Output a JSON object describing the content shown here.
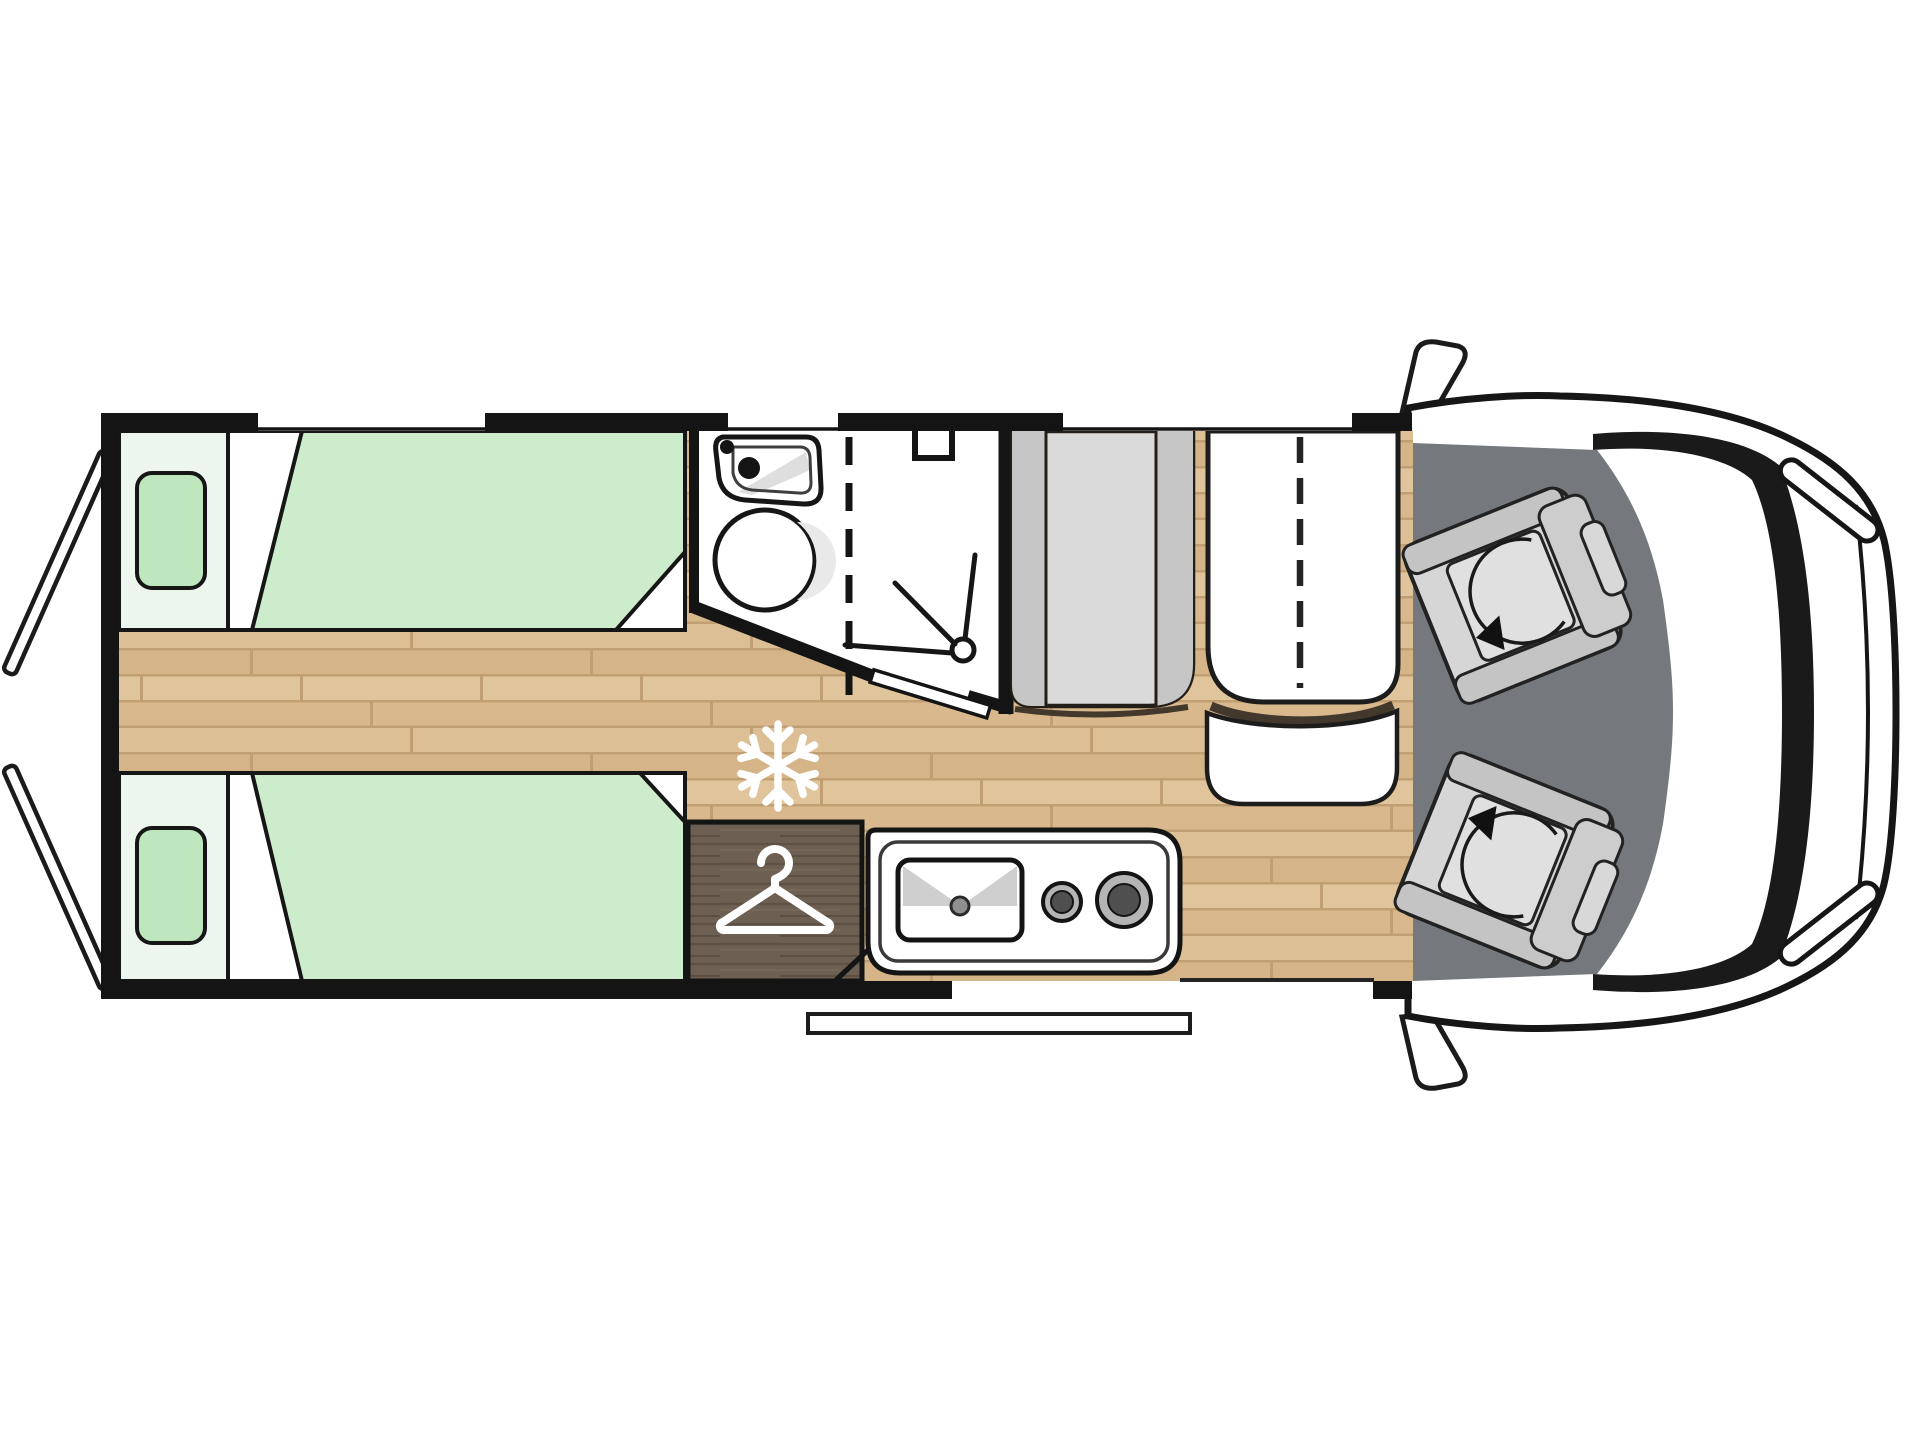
{
  "meta": {
    "title": "Campervan floor plan, top view",
    "description": "Schematic top-view floor plan: rear twin single beds, central washroom with shower, wardrobe, kitchen block with sink and two burners, dinette with folding table, driver cab with two swivel seats, open rear doors and side entry step."
  },
  "colors": {
    "background": "#ffffff",
    "wall": "#141414",
    "outline": "#1b1b1b",
    "wood_base": "#d9ba8e",
    "wood_row1": "#ddbf95",
    "wood_row2": "#d5b487",
    "wood_row3": "#e0c49b",
    "wood_row4": "#d8b88c",
    "wood_seam": "#c29f73",
    "mattress_green": "#cdeccb",
    "pillow_green": "#bfe7bd",
    "bed_head_pale": "#edf6ee",
    "bathroom_white": "#ffffff",
    "bench_main": "#dadada",
    "bench_strip": "#c6c6c6",
    "table_white": "#ffffff",
    "side_seat_white": "#ffffff",
    "shadow_brown": "#43382c",
    "cab_floor_gray": "#75797e",
    "seat_body": "#d6d6d6",
    "seat_band": "#c4c4c4",
    "seat_cushion": "#e0e0e0",
    "wardrobe_base": "#6d5f52",
    "wardrobe_streak_dark": "#5e5246",
    "wardrobe_streak_light": "#786a5b",
    "vehicle_body_white": "#ffffff",
    "windshield_black": "#1a1a1a",
    "burner_ring": "#b5b5b5",
    "burner_center": "#4f4f4f",
    "faucet_gray": "#8f8f8f",
    "basin_shade": "#e9e9e9",
    "sink_wing_gray": "#cfcfcf",
    "icon_white": "#ffffff"
  },
  "zones": [
    {
      "id": "rear-bedroom",
      "label": "Twin single beds"
    },
    {
      "id": "washroom",
      "label": "Washbasin and toilet"
    },
    {
      "id": "shower",
      "label": "Shower cubicle"
    },
    {
      "id": "wardrobe",
      "label": "Wardrobe"
    },
    {
      "id": "kitchen",
      "label": "Kitchen block"
    },
    {
      "id": "dinette",
      "label": "Dinette with folding table"
    },
    {
      "id": "cab",
      "label": "Driver cab with swivel seats"
    }
  ],
  "icons": [
    {
      "name": "snowflake-icon",
      "meaning": "fridge position"
    },
    {
      "name": "hanger-icon",
      "meaning": "wardrobe"
    },
    {
      "name": "shower-head-icon",
      "meaning": "shower"
    },
    {
      "name": "swivel-arrow-icon",
      "meaning": "rotating cab seat"
    }
  ]
}
